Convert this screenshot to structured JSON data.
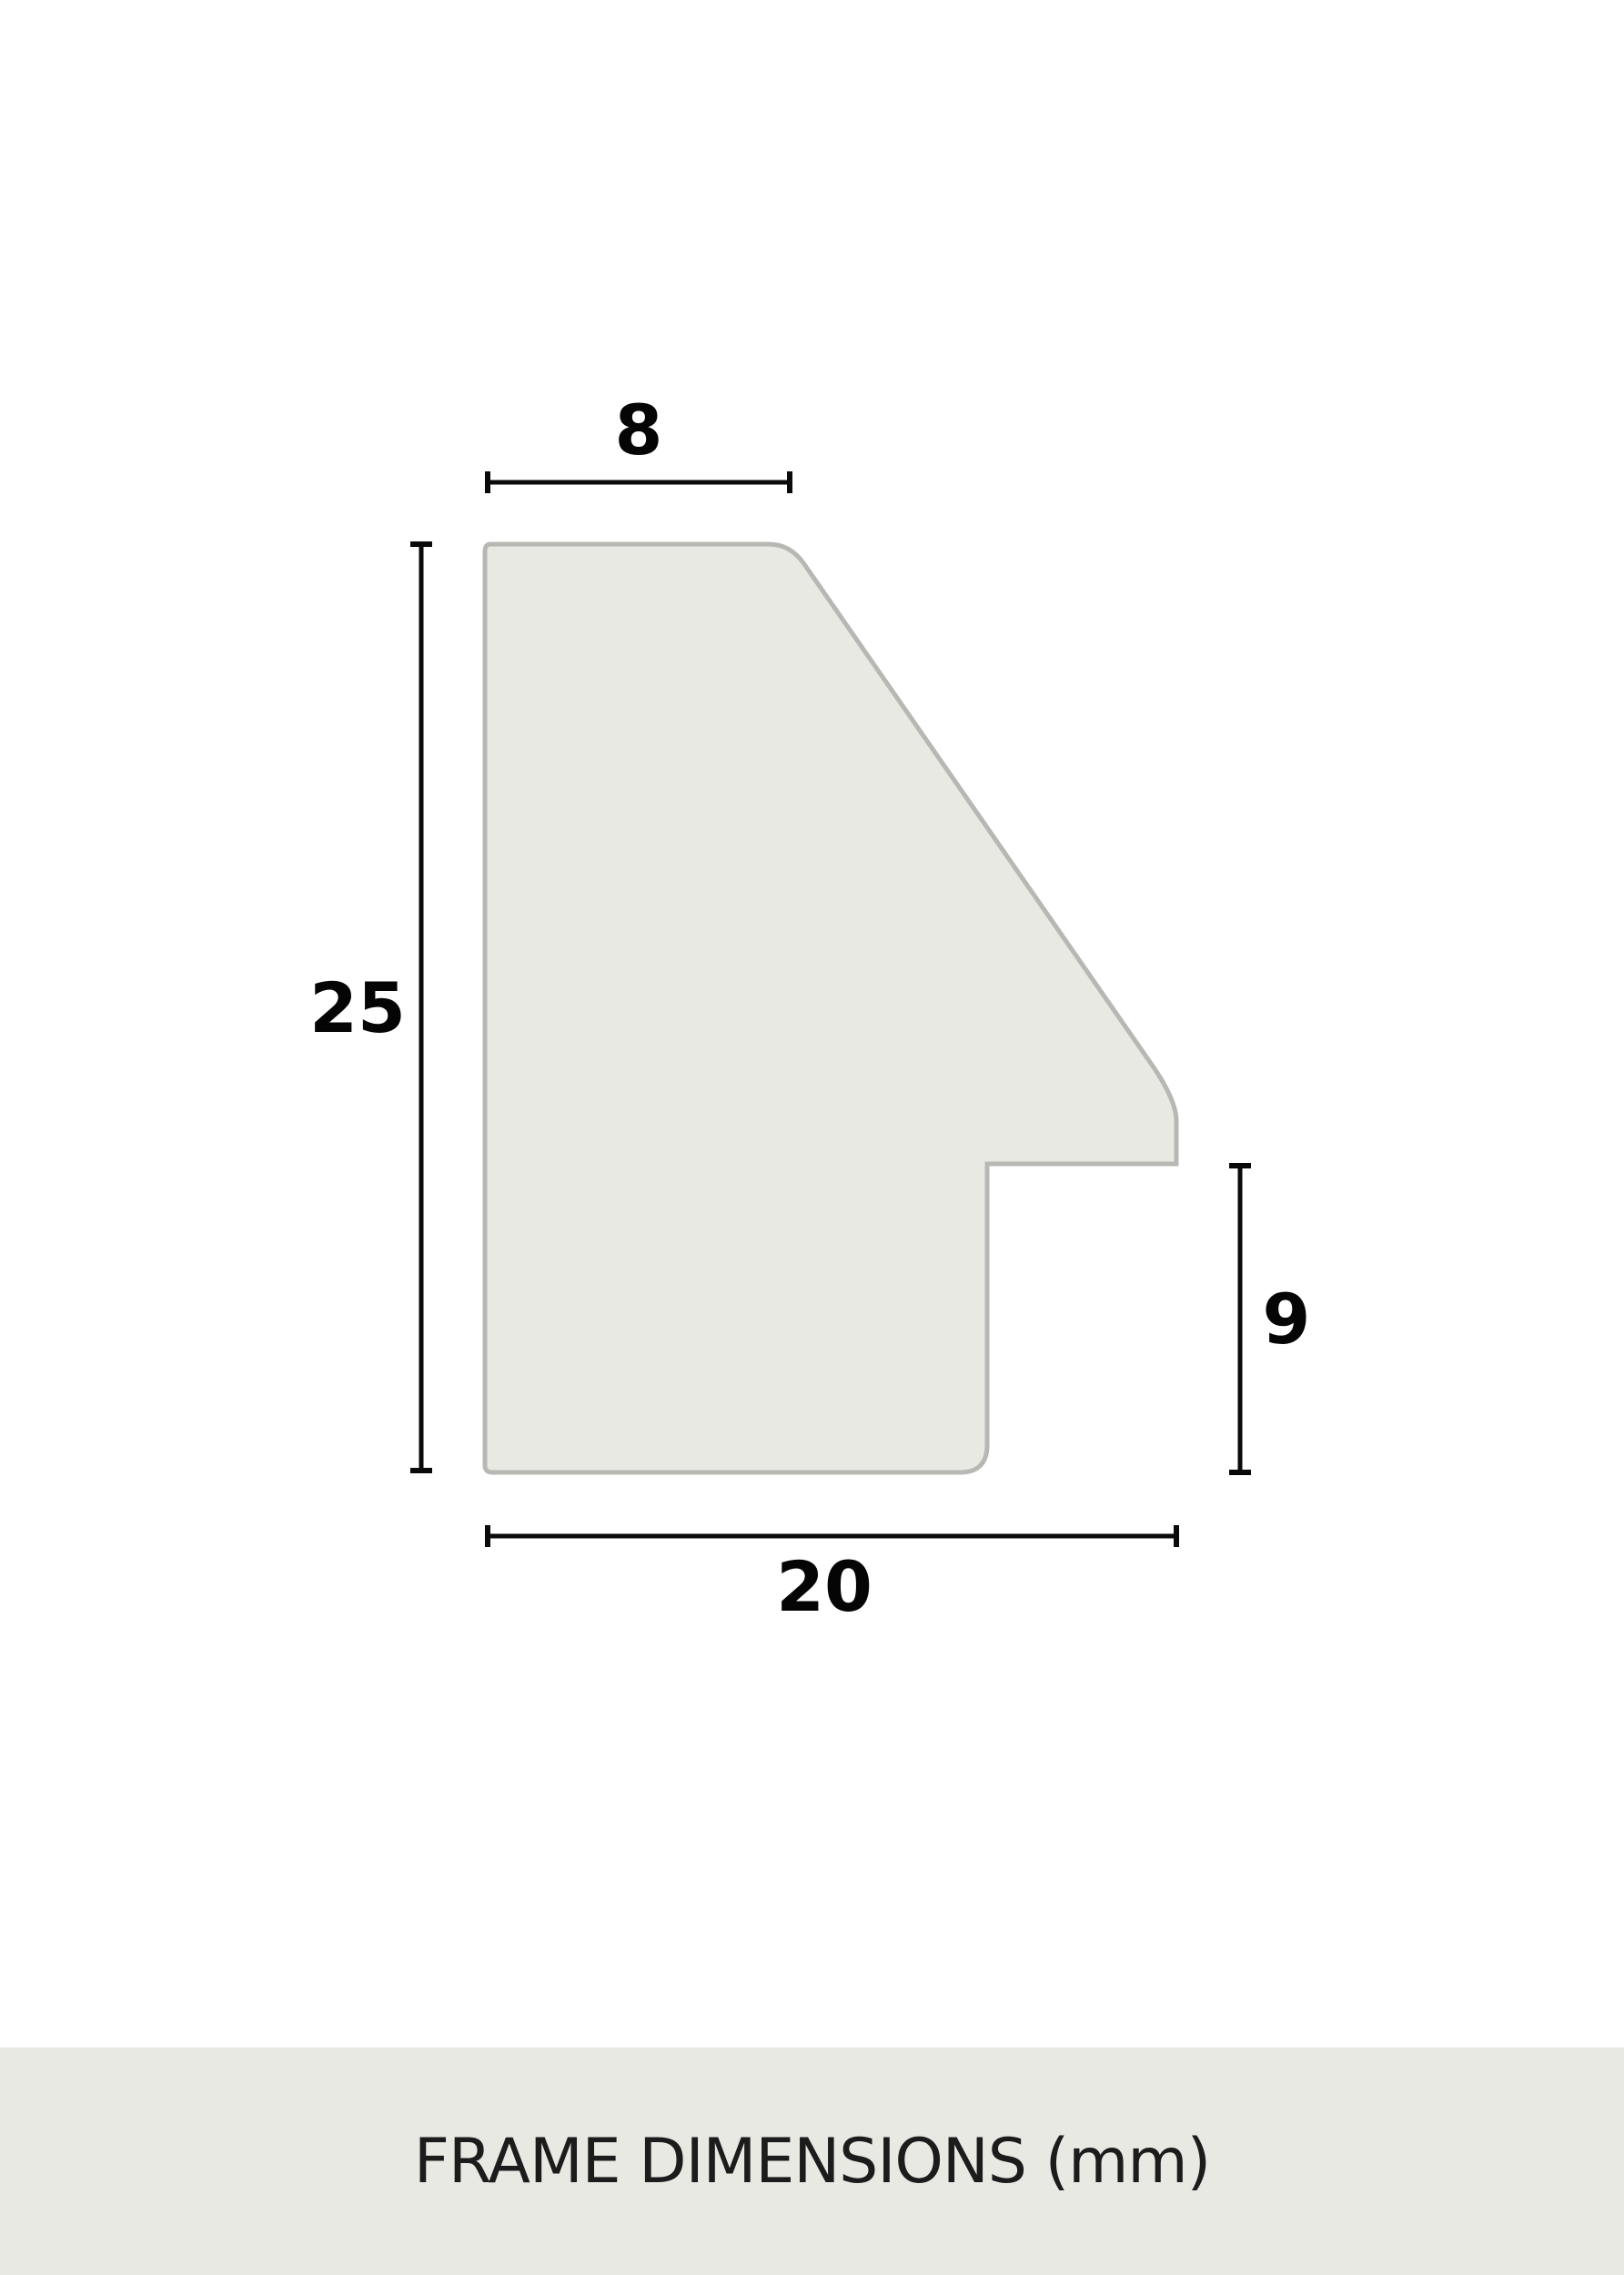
{
  "diagram": {
    "name": "frame-profile-cross-section",
    "unit": "mm",
    "shape": {
      "description": "Frame moulding profile outline with angled top-right face and rabbet notch",
      "fill_color": "#e9e9e4",
      "stroke_color": "#b7b7b3"
    },
    "dimensions": {
      "top_width": {
        "label": "8",
        "value": 8,
        "side": "top"
      },
      "left_height": {
        "label": "25",
        "value": 25,
        "side": "left"
      },
      "right_height": {
        "label": "9",
        "value": 9,
        "side": "right"
      },
      "bottom_width": {
        "label": "20",
        "value": 20,
        "side": "bottom"
      }
    },
    "colors": {
      "background": "#ffffff",
      "dimension_line": "#0a0a0a",
      "label_text": "#050505"
    }
  },
  "footer": {
    "title": "FRAME DIMENSIONS (mm)",
    "background": "#e9e9e3",
    "text_color": "#1c1c1c"
  }
}
